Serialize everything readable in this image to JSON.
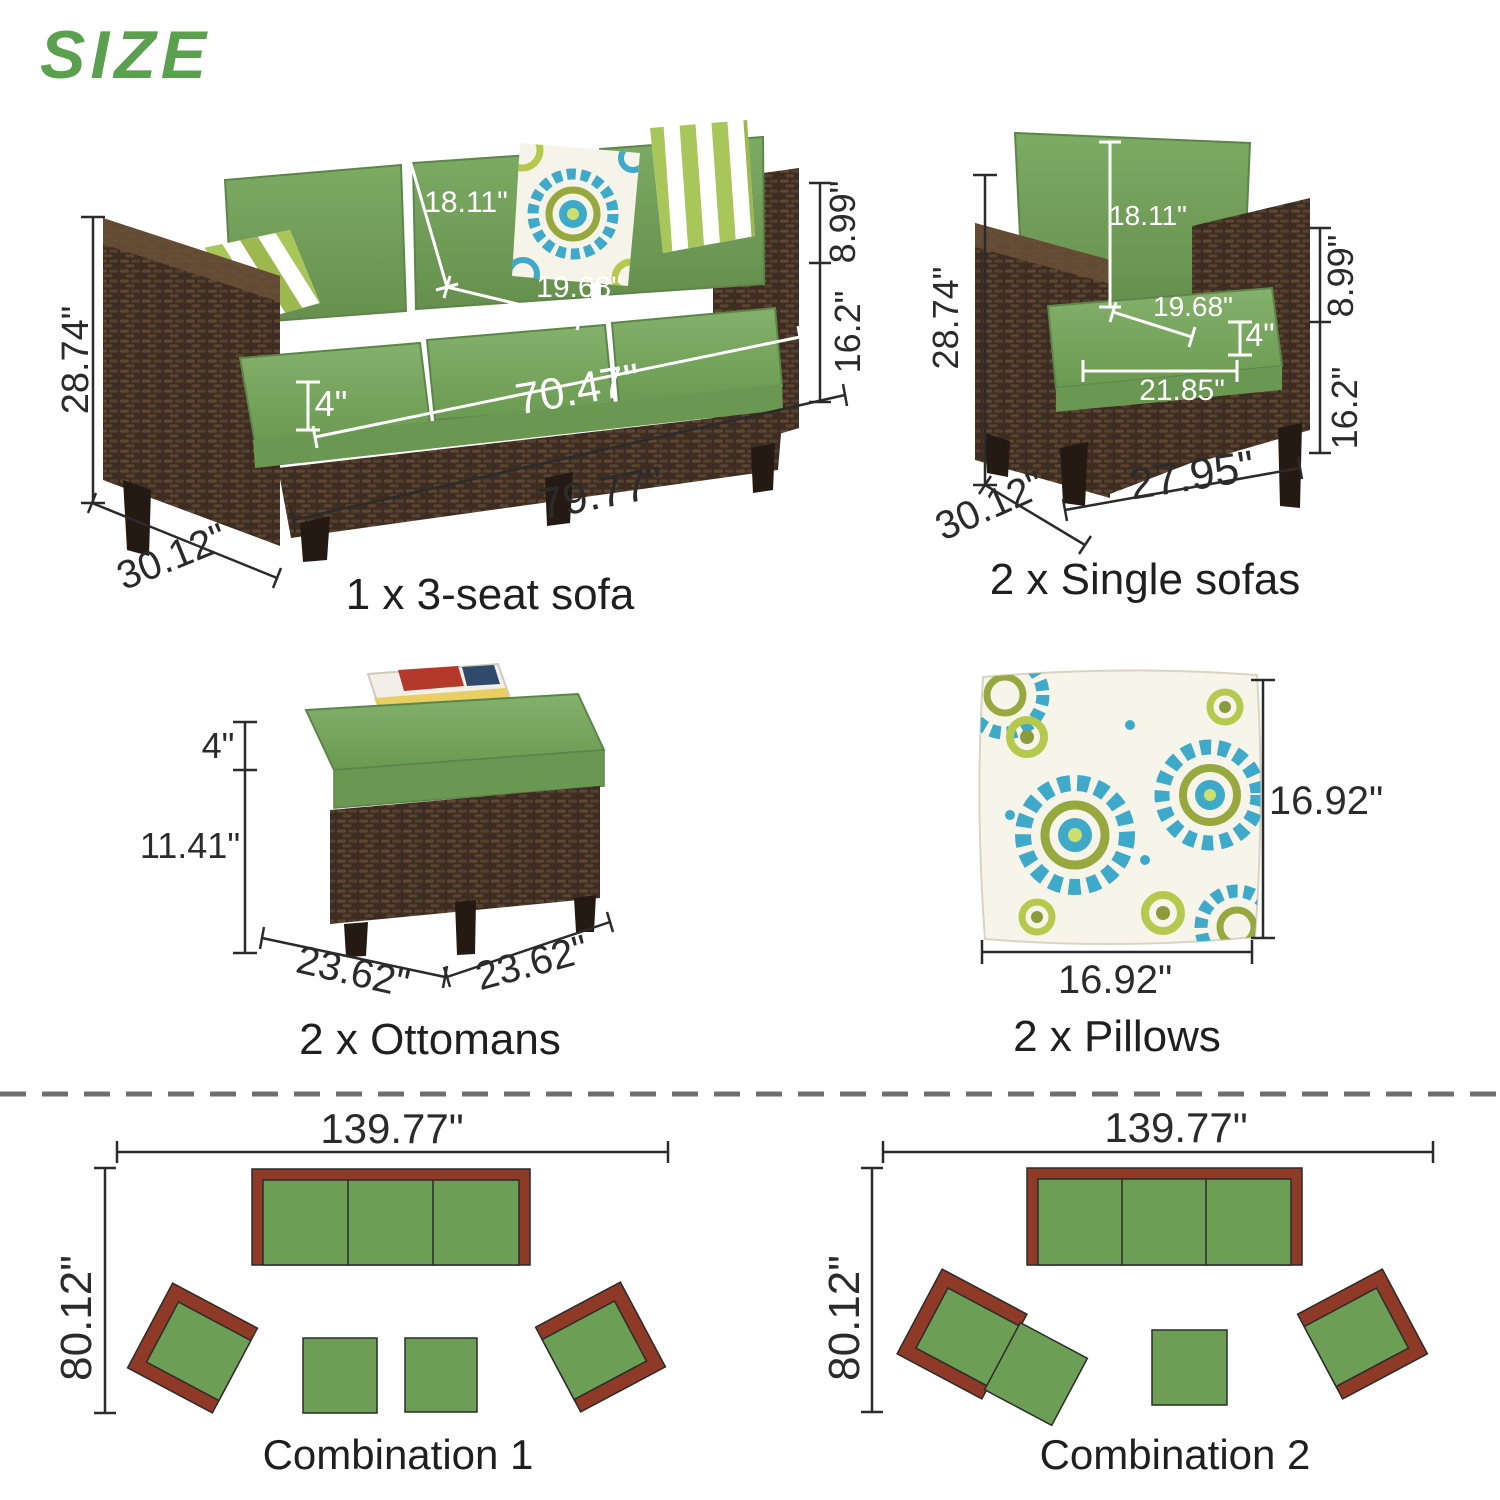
{
  "title": "SIZE",
  "colors": {
    "accent_green": "#5ba04e",
    "cushion_green": "#74a35c",
    "wicker_brown": "#3c2c21",
    "plan_green": "#6d9e55",
    "plan_maroon": "#8e3a26",
    "pillow_teal": "#3fa9c9",
    "pillow_lime": "#b5c94e",
    "dim_line_dark": "#2b2b2b",
    "dim_line_light": "#ffffff"
  },
  "products": {
    "sofa": {
      "caption": "1 x 3-seat sofa",
      "dims": {
        "height": "28.74\"",
        "back_cushion_height": "18.11\"",
        "seat_depth": "19.68\"",
        "cushion_thickness": "4\"",
        "inner_width": "70.47\"",
        "overall_width": "79.77\"",
        "arm_above_seat": "8.99\"",
        "seat_height": "16.2\"",
        "depth": "30.12\""
      }
    },
    "single_sofa": {
      "caption": "2 x Single sofas",
      "dims": {
        "height": "28.74\"",
        "back_cushion_height": "18.11\"",
        "seat_depth": "19.68\"",
        "cushion_thickness": "4\"",
        "seat_width": "21.85\"",
        "arm_above_seat": "8.99\"",
        "seat_height": "16.2\"",
        "overall_width": "27.95\"",
        "depth": "30.12\""
      }
    },
    "ottoman": {
      "caption": "2 x Ottomans",
      "dims": {
        "cushion_thickness": "4\"",
        "base_height": "11.41\"",
        "width": "23.62\"",
        "depth": "23.62\""
      }
    },
    "pillow": {
      "caption": "2 x Pillows",
      "dims": {
        "width": "16.92\"",
        "height": "16.92\""
      }
    }
  },
  "combinations": {
    "combo1": {
      "caption": "Combination 1",
      "width": "139.77\"",
      "depth": "80.12\""
    },
    "combo2": {
      "caption": "Combination 2",
      "width": "139.77\"",
      "depth": "80.12\""
    }
  }
}
